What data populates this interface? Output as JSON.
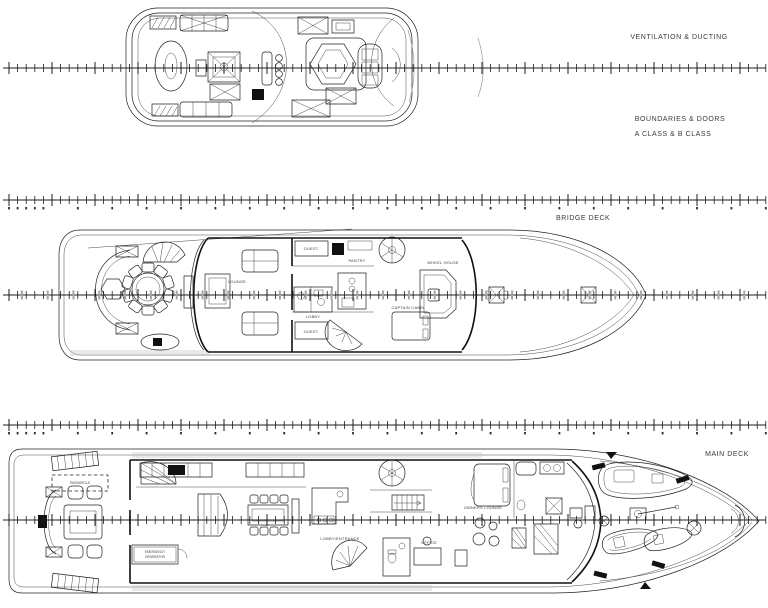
{
  "document": {
    "type": "yacht-general-arrangement-plan",
    "background": "#ffffff",
    "line_color": "#222222",
    "gray_accent": "#9a9a9a"
  },
  "annotations": {
    "ventilation": "VENTILATION & DUCTING",
    "boundaries_line1": "BOUNDARIES & DOORS",
    "boundaries_line2": "A CLASS & B CLASS",
    "bridge_deck": "BRIDGE DECK",
    "main_deck": "MAIN DECK"
  },
  "decks": {
    "sun_deck": {
      "features": [
        "sun-loungers",
        "jacuzzi-hexagon",
        "mast-crane",
        "bar-stools",
        "bench"
      ]
    },
    "bridge": {
      "rooms": {
        "lounge": "LOUNGE",
        "guest_fwd": "GUEST",
        "guest_aft": "GUEST",
        "pantry": "PANTRY",
        "lobby": "LOBBY",
        "captain": "CAPTAIN CABIN",
        "wheelhouse": "WHEEL HOUSE"
      }
    },
    "main": {
      "rooms": {
        "passarelle": "PASSARELLE",
        "emergency_1": "EMERGENCY",
        "emergency_2": "GENERATOR",
        "lobby_entrance": "LOBBY/ENTRANCE",
        "office": "OFFICE",
        "owners_lounge": "OWNERS LOUNGE"
      }
    }
  },
  "rulers": {
    "x0": 3,
    "x1": 766,
    "minor_spacing": 8.6,
    "major_every": 5,
    "rows": [
      {
        "y": 68,
        "numbers": false,
        "gray": false
      },
      {
        "y": 200,
        "numbers": true,
        "gray": false
      },
      {
        "y": 295,
        "numbers": false,
        "gray": true
      },
      {
        "y": 425,
        "numbers": true,
        "gray": false
      },
      {
        "y": 520,
        "numbers": false,
        "gray": false
      }
    ]
  }
}
